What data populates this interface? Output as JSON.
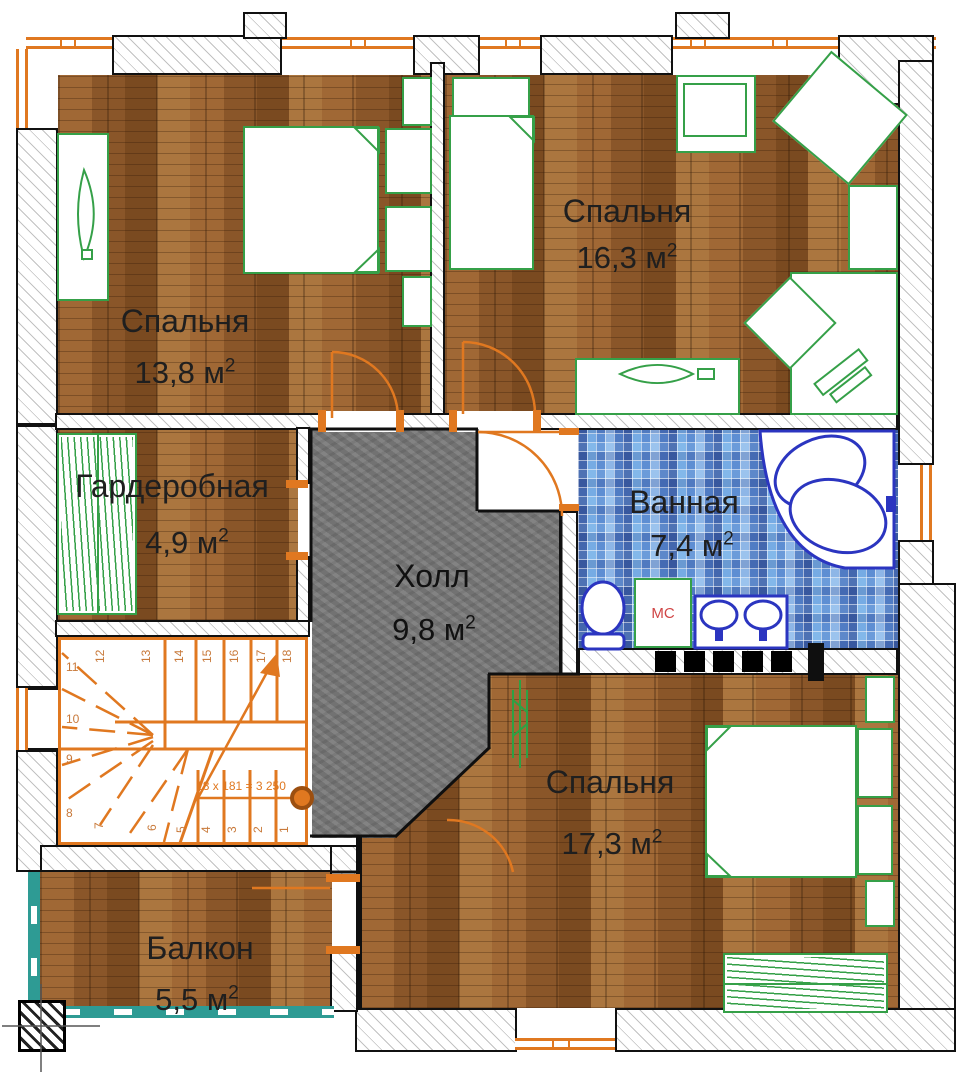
{
  "plan": {
    "sup": "2",
    "rooms": {
      "bedroom1": {
        "name": "Спальня",
        "area": "13,8 м"
      },
      "bedroom2": {
        "name": "Спальня",
        "area": "16,3 м"
      },
      "wardrobe": {
        "name": "Гардеробная",
        "area": "4,9 м"
      },
      "hall": {
        "name": "Холл",
        "area": "9,8 м"
      },
      "bathroom": {
        "name": "Ванная",
        "area": "7,4 м"
      },
      "bedroom3": {
        "name": "Спальня",
        "area": "17,3 м"
      },
      "balcony": {
        "name": "Балкон",
        "area": "5,5 м"
      }
    },
    "bathroom_labels": {
      "washing_machine": "МС"
    },
    "stairs": {
      "formula": "18 x 181 = 3 250",
      "numbers": [
        "1",
        "2",
        "3",
        "4",
        "5",
        "6",
        "7",
        "8",
        "9",
        "10",
        "11",
        "12",
        "13",
        "14",
        "15",
        "16",
        "17",
        "18"
      ]
    },
    "colors": {
      "door_window_accent": "#e07820",
      "furniture_green": "#35a048",
      "sanitary_blue": "#2b35c0",
      "balcony_teal": "#2e9b94",
      "washer_label_red": "#d04545",
      "wood_floor": "#936030",
      "hall_floor": "#7b7b7b",
      "tile_blue": "#7aa7dd",
      "wall_outline": "#111111"
    }
  }
}
